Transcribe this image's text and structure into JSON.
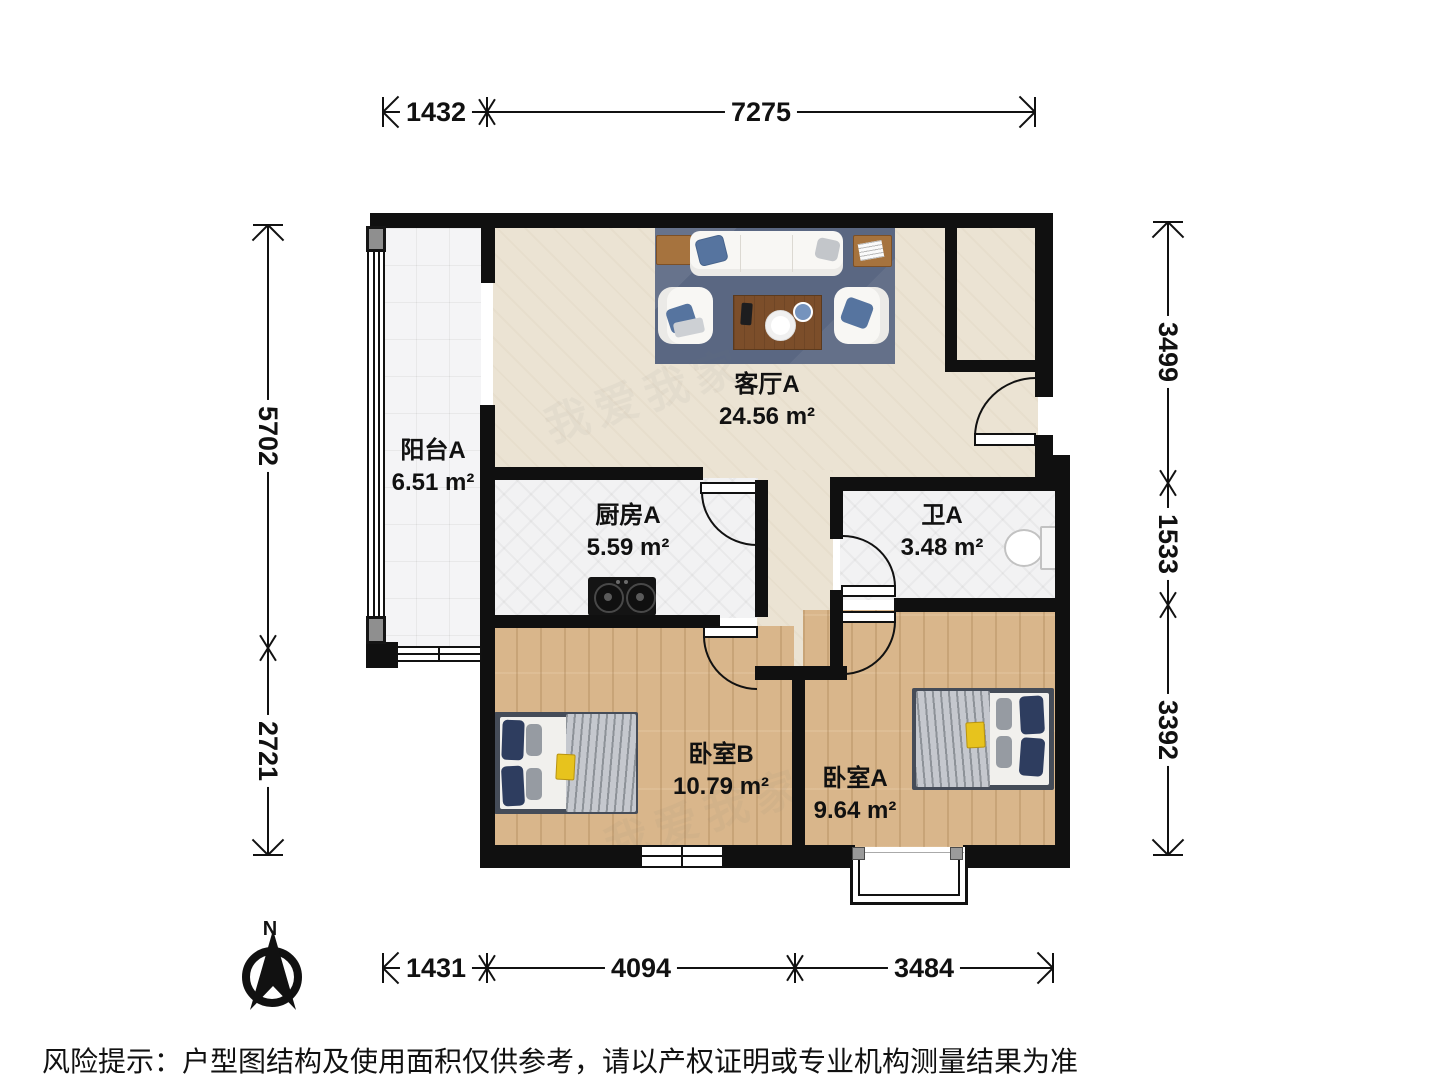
{
  "rooms": [
    {
      "name": "阳台A",
      "area": "6.51 m²"
    },
    {
      "name": "客厅A",
      "area": "24.56 m²"
    },
    {
      "name": "厨房A",
      "area": "5.59 m²"
    },
    {
      "name": "卫A",
      "area": "3.48 m²"
    },
    {
      "name": "卧室B",
      "area": "10.79 m²"
    },
    {
      "name": "卧室A",
      "area": "9.64 m²"
    }
  ],
  "dimensions": {
    "top": [
      "1432",
      "7275"
    ],
    "bottom": [
      "1431",
      "4094",
      "3484"
    ],
    "left": [
      "5702",
      "2721"
    ],
    "right": [
      "3499",
      "1533",
      "3392"
    ]
  },
  "compass": {
    "label": "N"
  },
  "disclaimer": "风险提示：户型图结构及使用面积仅供参考，请以产权证明或专业机构测量结果为准",
  "watermark": "我爱我家",
  "colors": {
    "wall": "#101010",
    "beige_floor": "#ebe3d3",
    "tile_floor": "#f2f2f3",
    "balcony_floor": "#f4f4f6",
    "wood_floor": "#d9b68b",
    "rug": "#5a6782",
    "sofa": "#f8f7f4",
    "pillow_blue": "#56749f",
    "pillow_navy": "#2e3d5f",
    "side_table_wood": "#a6733e",
    "coffee_table_wood": "#7c4e2a",
    "bed_frame": "#454c58",
    "blanket_gray": "#b6bac0",
    "accent_yellow": "#e7c31d"
  }
}
